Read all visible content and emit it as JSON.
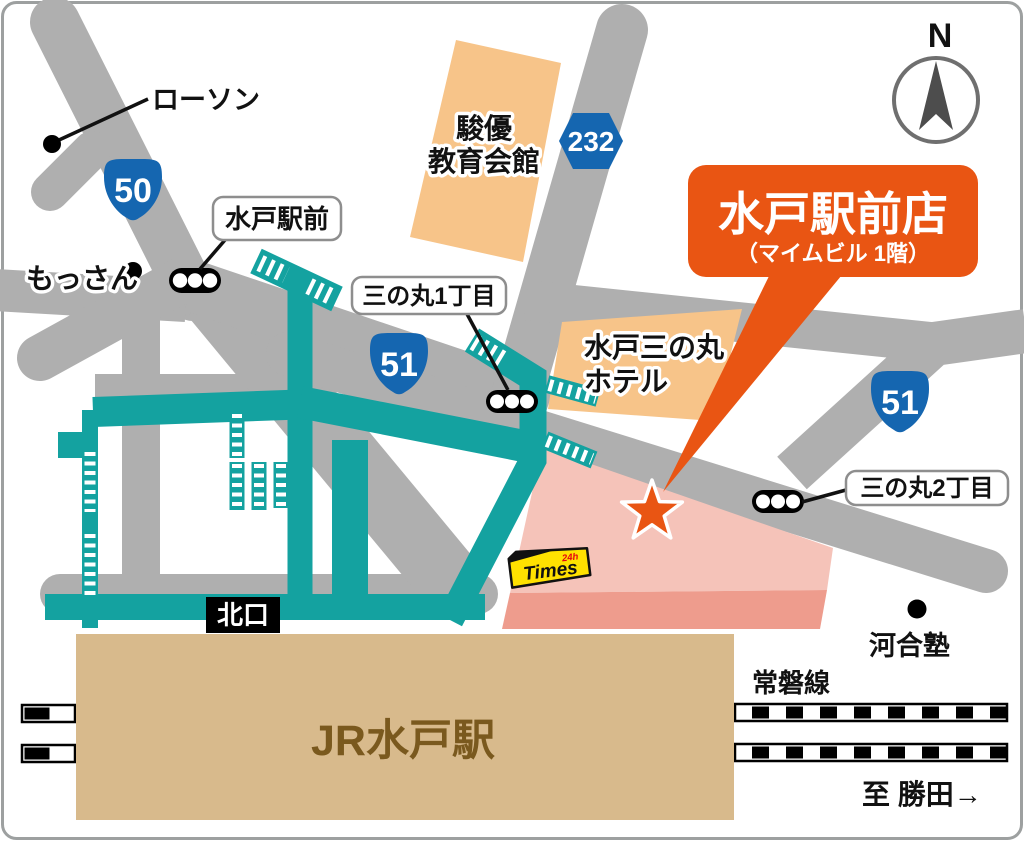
{
  "labels": {
    "lawson": "ローソン",
    "mossan": "もっさん",
    "shunyu1": "駿優",
    "shunyu2": "教育会館",
    "hotel1": "水戸三の丸",
    "hotel2": "ホテル",
    "kawaijuku": "河合塾",
    "joban_line": "常磐線",
    "to_katsuta": "至 勝田→",
    "jr_station": "JR水戸駅",
    "north_exit": "北口",
    "mito_ekimae": "水戸駅前",
    "sannomaru1": "三の丸1丁目",
    "sannomaru2": "三の丸2丁目",
    "compass_n": "N"
  },
  "routes": {
    "r50": "50",
    "r51a": "51",
    "r51b": "51",
    "r232": "232"
  },
  "store": {
    "name": "水戸駅前店",
    "floor_note": "（マイムビル 1階）"
  },
  "parking": {
    "brand": "Times",
    "badge": "24h"
  },
  "colors": {
    "road": "#AFAFAF",
    "deck": "#14A2A0",
    "building_orange": "#F7C489",
    "pink_top": "#F5C3B9",
    "pink_side": "#EE9C8D",
    "station_tan": "#D8BA8C",
    "station_text": "#7A591E",
    "badge_blue": "#1566B0",
    "accent_orange": "#E95513",
    "times_yellow": "#FFE100",
    "times_red": "#E60012",
    "label_border": "#8E8E8E",
    "compass_gray": "#4D4D4D",
    "border_gray": "#9DA0A0"
  }
}
